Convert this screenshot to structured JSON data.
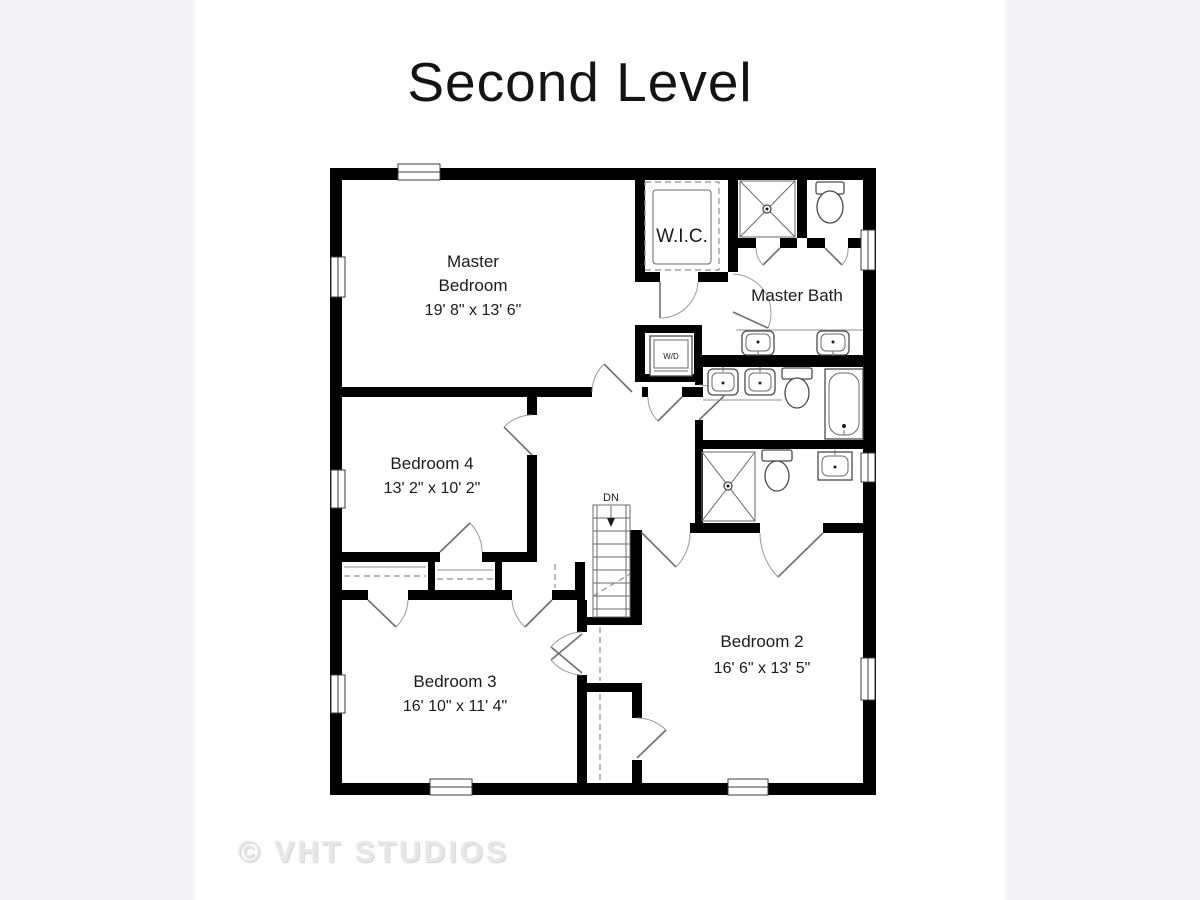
{
  "page": {
    "title": "Second Level",
    "watermark": "© VHT STUDIOS"
  },
  "rooms": {
    "master_bedroom": {
      "name_line1": "Master",
      "name_line2": "Bedroom",
      "dims": "19' 8\" x 13' 6\""
    },
    "wic": {
      "name": "W.I.C."
    },
    "master_bath": {
      "name": "Master Bath"
    },
    "bedroom4": {
      "name": "Bedroom 4",
      "dims": "13' 2\" x 10' 2\""
    },
    "bedroom2": {
      "name": "Bedroom 2",
      "dims": "16' 6\" x 13' 5\""
    },
    "bedroom3": {
      "name": "Bedroom 3",
      "dims": "16' 10\" x 11' 4\""
    },
    "laundry": {
      "name": "W/D"
    },
    "stairs": {
      "label": "DN"
    }
  },
  "colors": {
    "wall": "#000000",
    "matte": "#f5f4f6",
    "text": "#1b1b1b",
    "watermark": "#e7e5e8"
  }
}
